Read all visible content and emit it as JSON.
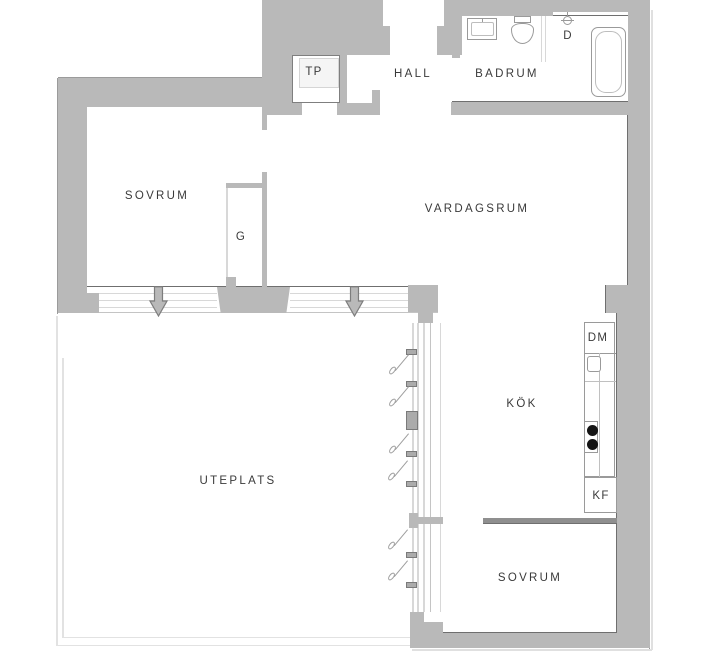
{
  "plan_title": "apartment-floor-plan",
  "colors": {
    "bg": "#ffffff",
    "wall": "#b9b9b9",
    "wallDark": "#8f8f8f",
    "edge": "#6f6f6f",
    "outer": "#9b9b9b",
    "glaze": "#d8d8d8",
    "glazeDark": "#c4c4c4",
    "patio": "#e2e2e2",
    "text": "#3a3a3a",
    "fixture": "#9a9a9a",
    "fixtureLight": "#bdbdbd",
    "burner": "#141414",
    "shadow": "#e0e0e0",
    "shelf": "#f5f5f5",
    "shelfBorder": "#d5d5d5"
  },
  "rooms": {
    "sovrum_top": {
      "label": "SOVRUM"
    },
    "garderob": {
      "label": "G"
    },
    "tp": {
      "label": "TP"
    },
    "hall": {
      "label": "HALL"
    },
    "badrum": {
      "label": "BADRUM"
    },
    "dusch": {
      "label": "D"
    },
    "vardagsrum": {
      "label": "VARDAGSRUM"
    },
    "kok": {
      "label": "KÖK"
    },
    "uteplats": {
      "label": "UTEPLATS"
    },
    "sovrum_bottom": {
      "label": "SOVRUM"
    }
  },
  "appliances": {
    "dishwasher": {
      "label": "DM"
    },
    "fridge_freezer": {
      "label": "KF"
    }
  }
}
